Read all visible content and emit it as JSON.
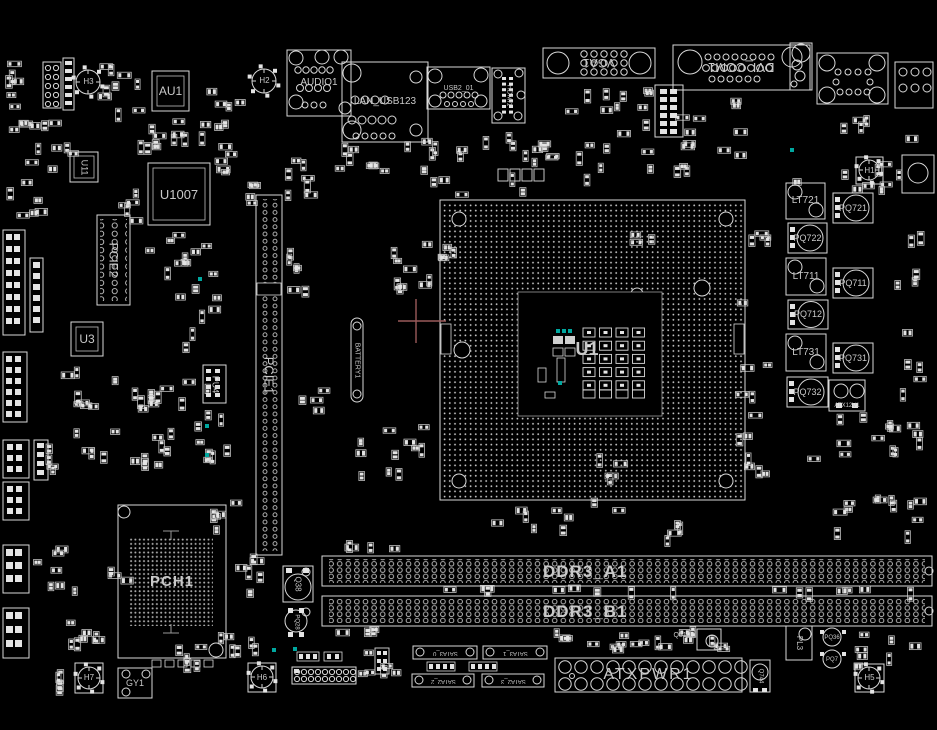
{
  "view": {
    "type": "pcb-boardview",
    "width": 937,
    "height": 730
  },
  "colors": {
    "background": "#000000",
    "outline": "#d9d9d9",
    "designator_label": "#c9c9c9",
    "connector_label": "#8f8f8f",
    "big_label": "#767676",
    "highlight_teal": "#00a79f",
    "crosshair": "#9b5a5a"
  },
  "labels": {
    "h3": "H3",
    "h2": "H2",
    "h1": "H1",
    "h7": "H7",
    "h6": "H6",
    "h5": "H5",
    "au1": "AU1",
    "audio1": "AUDIO1",
    "lan_usb": "LAN_USB123",
    "usb2_01": "USB2_01",
    "hdmi1": "HDMI1",
    "vga1": "VGA1",
    "dvi_com1": "DVI_COM1",
    "u11": "U11",
    "u1007": "U1007",
    "pcie2": "PCIE2",
    "u3": "U3",
    "pu4": "PU4",
    "pcie1": "PCIE1",
    "battery1": "BATTERY1",
    "u1": "U1",
    "lt721": "LT721",
    "pq721": "PQ721",
    "pq722": "PQ722",
    "lt711": "LT711",
    "pq711": "PQ711",
    "pq712": "PQ712",
    "lt731": "LT731",
    "pq731": "PQ731",
    "pq732": "PQ732",
    "atx12v1": "ATX12V1",
    "q38": "Q38",
    "pq28": "PQ28",
    "pch1": "PCH1",
    "ddr3_a1": "DDR3_A1",
    "ddr3_b1": "DDR3_B1",
    "atxpwr1": "ATXPWR1",
    "q810": "Q810",
    "sata_1": "SATA3_0",
    "sata_2": "SATA3_1",
    "sata_3": "SATA2_2",
    "sata_4": "SATA2_3",
    "gy1": "GY1",
    "pl3": "PL3",
    "q744": "Q744",
    "pq36": "PQ36",
    "pq7": "PQ7"
  }
}
